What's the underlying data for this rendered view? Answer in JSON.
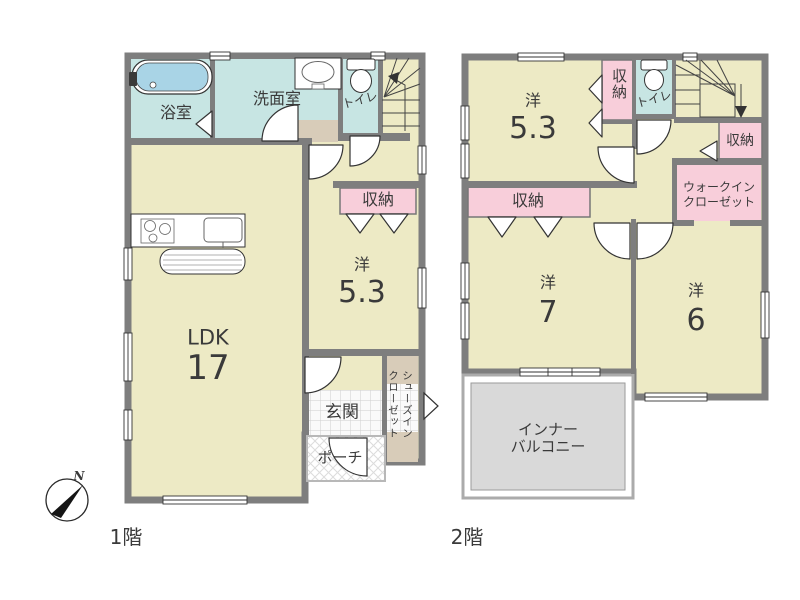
{
  "colors": {
    "room_cream": "#EDEAC5",
    "wet_blue": "#C7E5E3",
    "closet_pink": "#F8CEDA",
    "wall_gray": "#7E7E7E",
    "balcony_gray": "#D9D9D9",
    "mat_beige": "#D8CCB9",
    "tub_blue": "#A9D4E6"
  },
  "compass": {
    "north_label": "N"
  },
  "floor1": {
    "label": "1階",
    "rooms": {
      "bath": "浴室",
      "washroom": "洗面室",
      "toilet": "トイレ",
      "storage": "収納",
      "western_prefix": "洋",
      "western_size": "5.3",
      "ldk_prefix": "LDK",
      "ldk_size": "17",
      "entrance": "玄関",
      "porch": "ポーチ",
      "shoe_closet_col_right": "シューズイン",
      "shoe_closet_col_left": "クローゼット"
    }
  },
  "floor2": {
    "label": "2階",
    "rooms": {
      "western53_prefix": "洋",
      "western53_size": "5.3",
      "storage_top": "収納",
      "toilet": "トイレ",
      "storage_right": "収納",
      "walk_in_line1": "ウォークイン",
      "walk_in_line2": "クローゼット",
      "storage_mid": "収納",
      "western7_prefix": "洋",
      "western7_size": "7",
      "western6_prefix": "洋",
      "western6_size": "6",
      "balcony_line1": "インナー",
      "balcony_line2": "バルコニー"
    }
  }
}
